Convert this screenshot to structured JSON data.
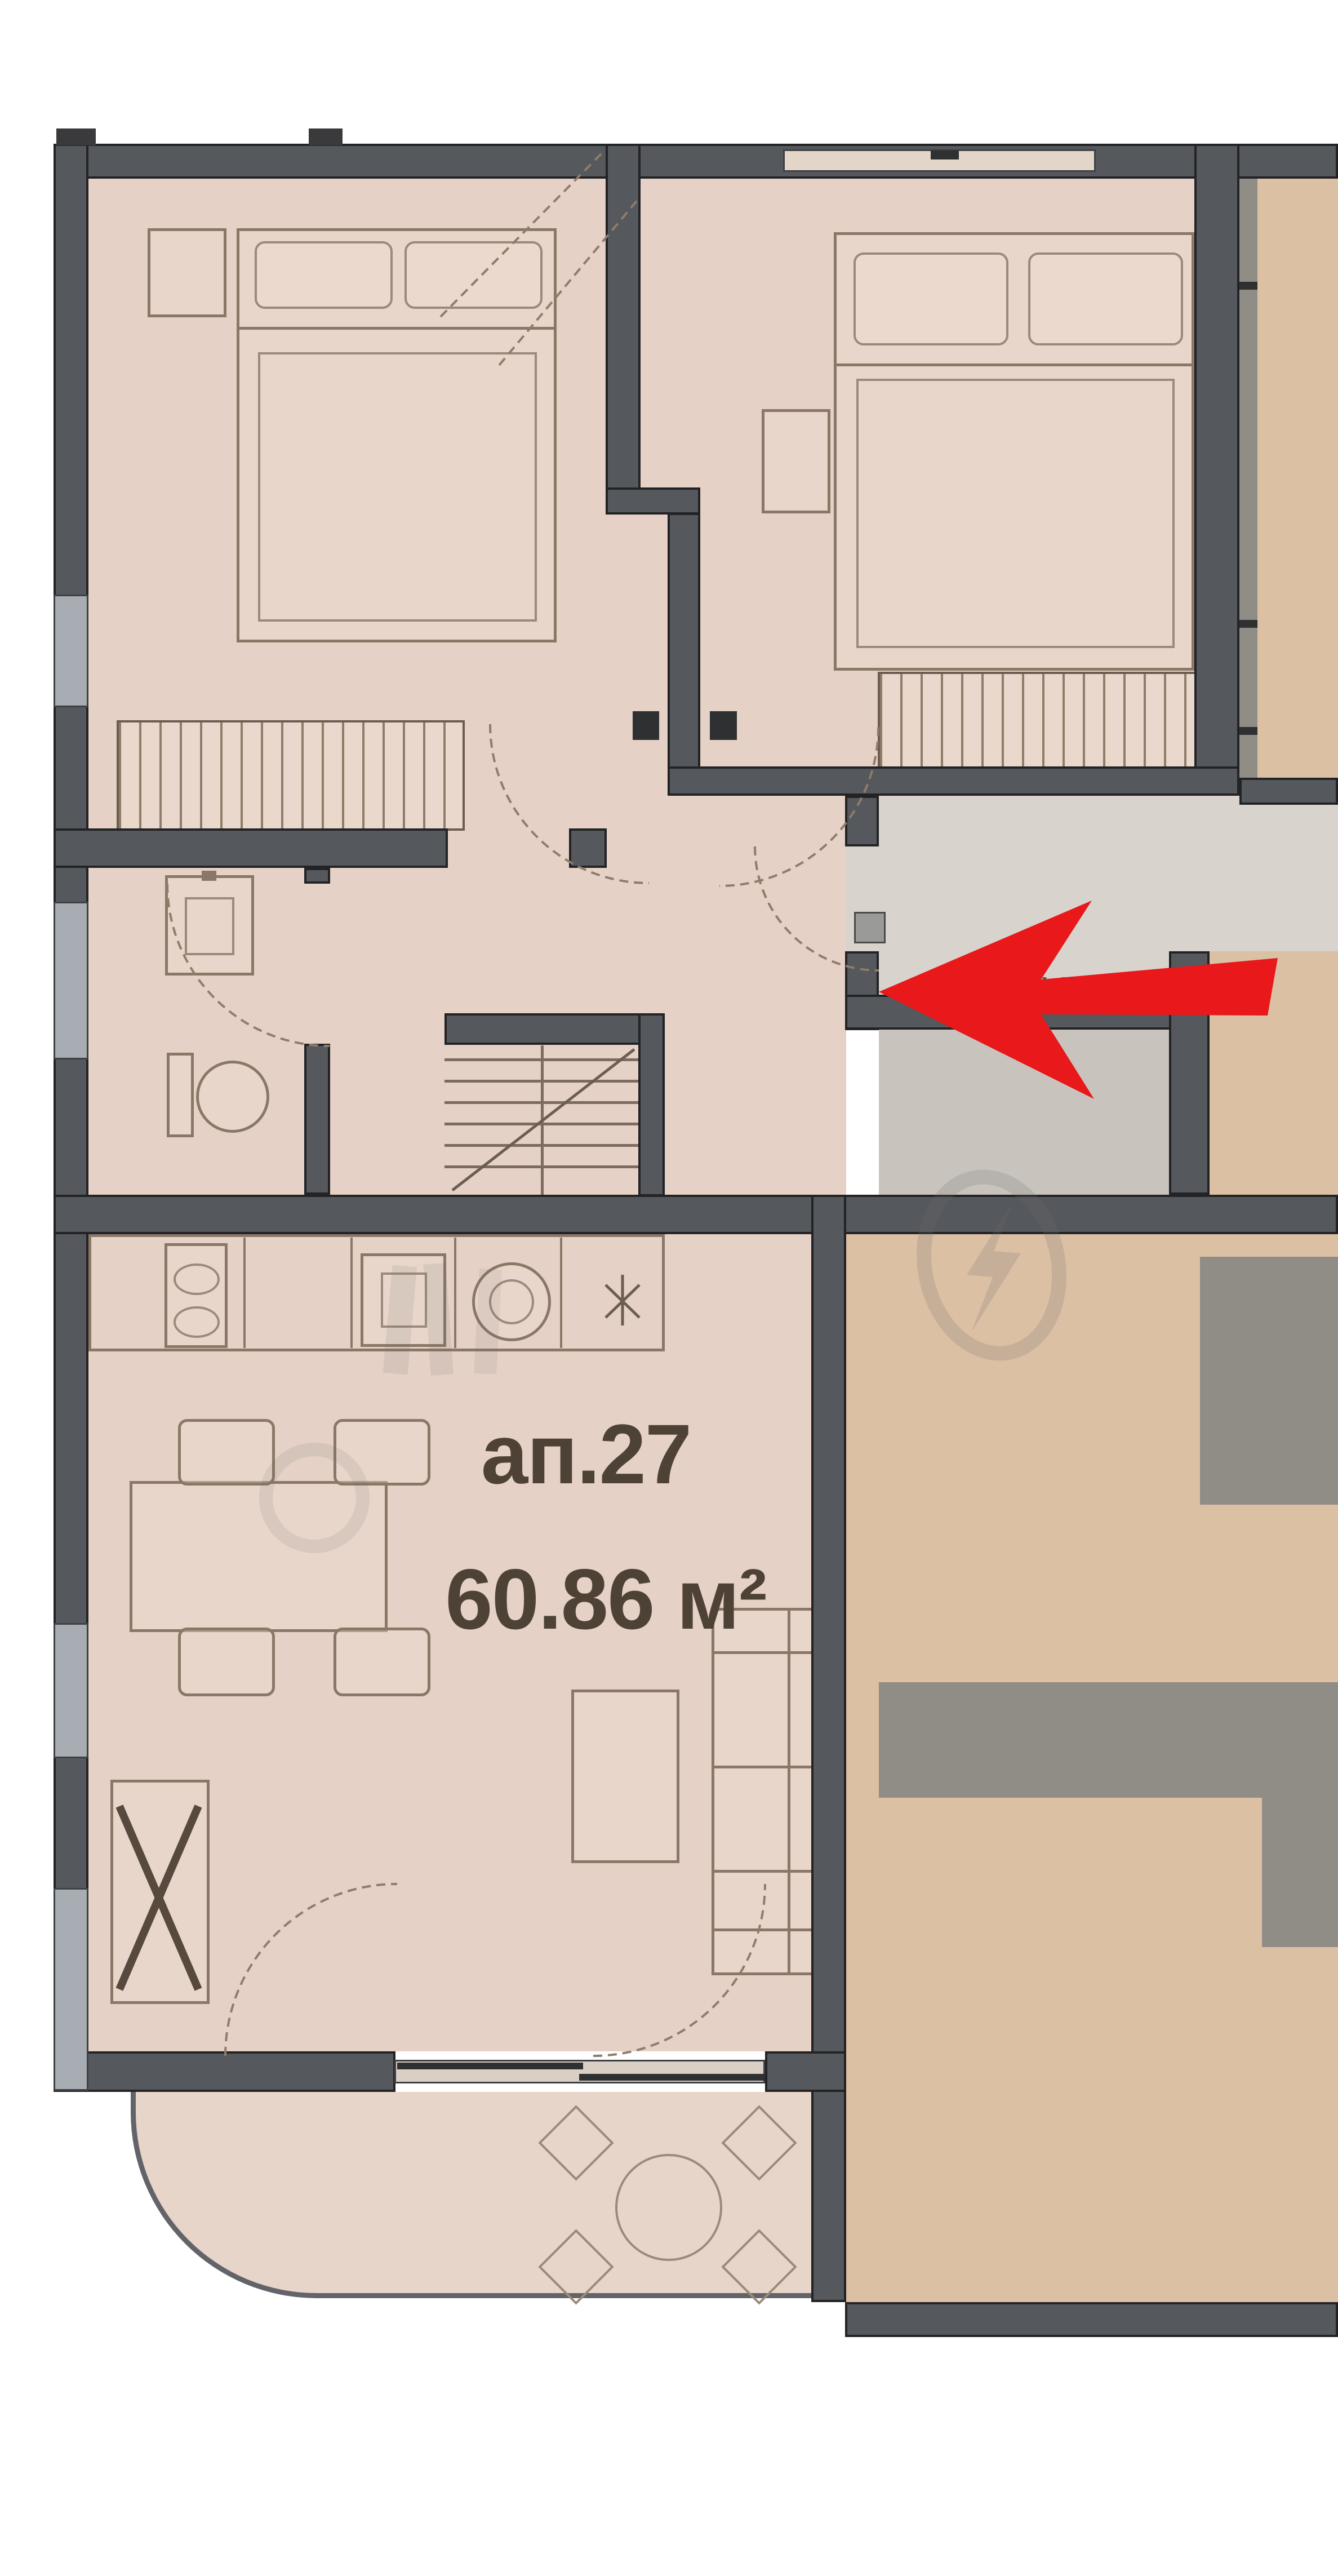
{
  "unit": {
    "label": "ап.27",
    "area": "60.86 м²"
  },
  "arrow": {
    "color": "#e8181b"
  },
  "palette": {
    "wall": "#55585d",
    "wall_edge": "#232326",
    "floor": "#e5d1c6",
    "neighbor_floor": "#dcc0a4",
    "window": "#a7adb2",
    "corridor_floor": "#d8d3cd",
    "furniture_line": "#8a7766",
    "gray_furniture": "#908d86",
    "label_text": "#4e4237",
    "watermark": "#6f6f6f"
  }
}
